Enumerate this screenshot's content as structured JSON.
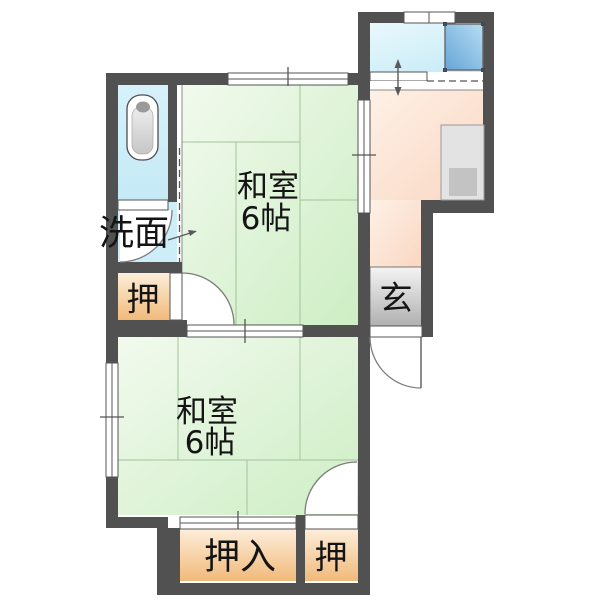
{
  "colors": {
    "wall": "#515151",
    "line": "#555555",
    "green_light": "#f2faee",
    "green_deep": "#cdeec4",
    "tatami_line": "#a3c29c",
    "pink_light": "#fef1e7",
    "pink_deep": "#fad7c2",
    "blueroom_light": "#e9f8fd",
    "blueroom_deep": "#c9ecf7",
    "bath_light": "#d6f1fa",
    "bath_deep": "#c5eaf6",
    "washroom": "#cdeef8",
    "orange_light": "#fdeeda",
    "orange_deep": "#f1ba7a",
    "gray_light": "#f4f4f4",
    "gray_deep": "#b0b0b0",
    "sink_light": "#b6ddf2",
    "sink_deep": "#66a5d7",
    "counter": "#e3e3e3",
    "counter_inner": "#c3c3c3",
    "text": "#141414"
  },
  "labels": {
    "washitsu_upper_name": "和室",
    "washitsu_upper_size": "6帖",
    "washitsu_lower_name": "和室",
    "washitsu_lower_size": "6帖",
    "senmen": "洗面",
    "oshiire_upper": "押",
    "genkan": "玄",
    "oshiire_lower": "押入",
    "oshi_lower": "押"
  }
}
